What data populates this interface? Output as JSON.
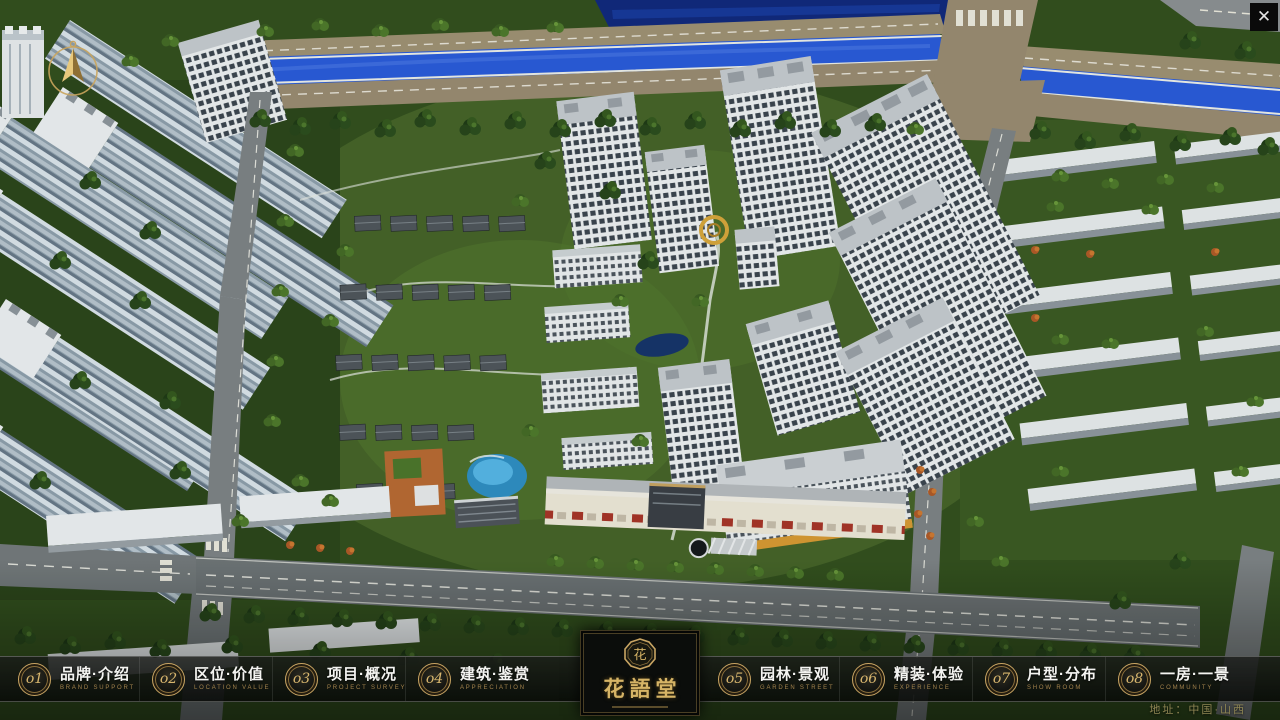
{
  "window": {
    "close_glyph": "✕"
  },
  "menu": {
    "items": [
      {
        "num": "o1",
        "zh": "品牌·介绍",
        "en": "BRAND SUPPORT"
      },
      {
        "num": "o2",
        "zh": "区位·价值",
        "en": "LOCATION VALUE"
      },
      {
        "num": "o3",
        "zh": "项目·概况",
        "en": "PROJECT SURVEY"
      },
      {
        "num": "o4",
        "zh": "建筑·鉴赏",
        "en": "APPRECIATION"
      },
      {
        "num": "o5",
        "zh": "园林·景观",
        "en": "GARDEN STREET"
      },
      {
        "num": "o6",
        "zh": "精装·体验",
        "en": "EXPERIENCE"
      },
      {
        "num": "o7",
        "zh": "户型·分布",
        "en": "SHOW ROOM"
      },
      {
        "num": "o8",
        "zh": "一房·一景",
        "en": "COMMUNITY"
      }
    ]
  },
  "logo": {
    "name": "花語堂",
    "emblem_char": "花"
  },
  "footer": {
    "address": "地址：中国·山西"
  },
  "colors": {
    "gold": "#c9a563",
    "river": "#2a5bdc",
    "bar_bg": "#0a0c0a"
  }
}
